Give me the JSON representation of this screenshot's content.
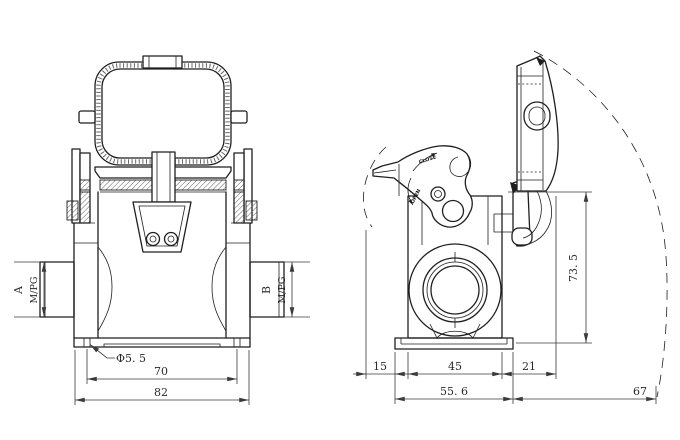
{
  "palette": {
    "line": "#1f1f1f",
    "dimension": "#3a3a3a",
    "background": "#ffffff"
  },
  "front_view": {
    "port_a": {
      "label": "A",
      "thread": "M/PG"
    },
    "port_b": {
      "label": "B",
      "thread": "M/PG"
    },
    "mount_hole_diameter": "Φ5. 5",
    "hole_spacing": "70",
    "flange_width": "82"
  },
  "side_view": {
    "lever": {
      "close_label": "CLOSE",
      "open_label": "OPEN"
    },
    "height": "73. 5",
    "lever_overhang": "15",
    "body_width": "45",
    "cover_offset": "21",
    "flange_width": "55. 6",
    "cover_swing_radius": "67"
  }
}
